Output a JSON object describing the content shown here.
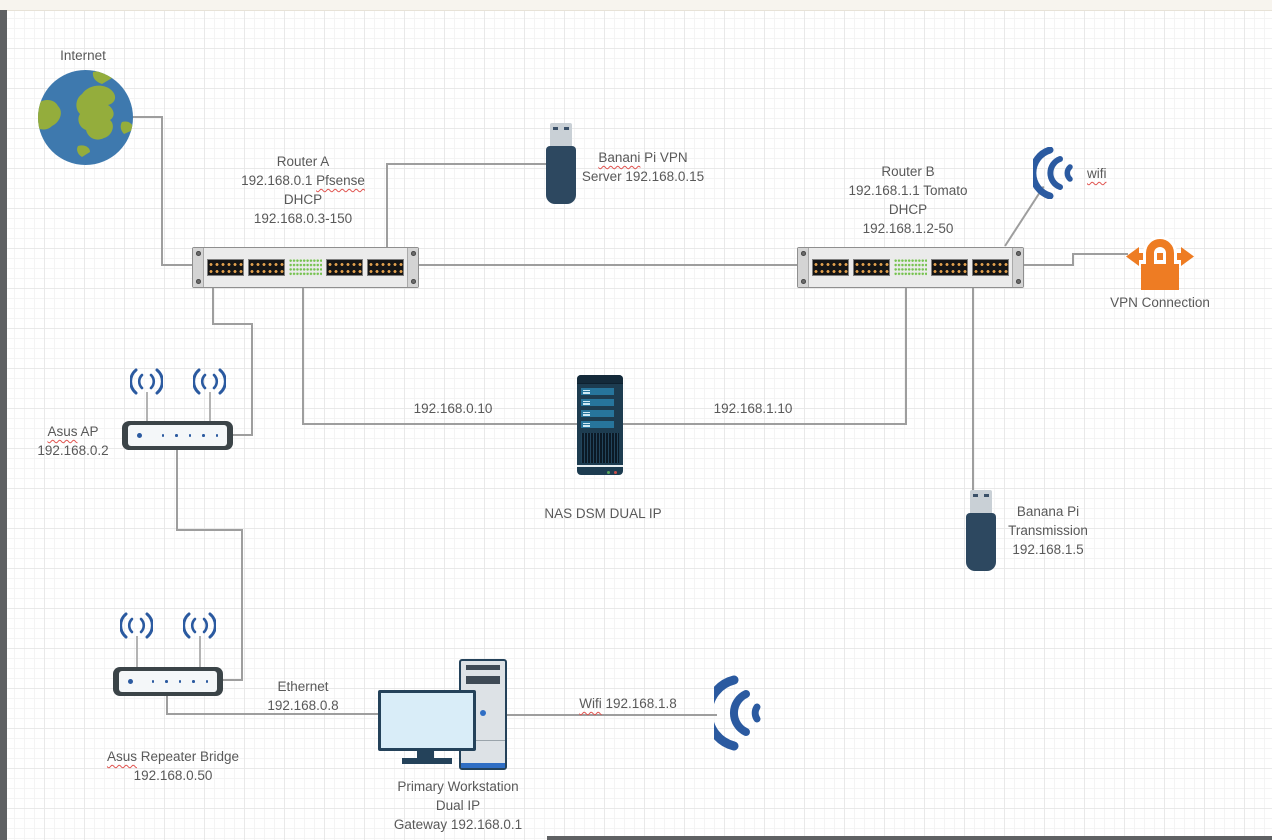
{
  "diagram_title": "Home network diagram (draw.io style canvas)",
  "colors": {
    "icon_blue": "#2b5aa0",
    "lock_orange": "#ee7c23",
    "globe_ocean": "#3e79ae",
    "globe_land": "#94ad3c",
    "connector_gray": "#9e9e9e",
    "led_green": "#76c24f",
    "port_pin_orange": "#e2a14e",
    "device_navy": "#2d4860",
    "text_gray": "#595959",
    "spellcheck_red": "#e0524e",
    "topbar_cream": "#f7f4ee",
    "scrollbar_gray": "#5f6163"
  },
  "nodes": {
    "internet": {
      "lines": [
        [
          {
            "t": "Internet"
          }
        ]
      ]
    },
    "router_a": {
      "lines": [
        [
          {
            "t": "Router A"
          }
        ],
        [
          {
            "t": "192.168.0.1 "
          },
          {
            "t": "Pfsense",
            "sq": true
          }
        ],
        [
          {
            "t": "DHCP"
          }
        ],
        [
          {
            "t": "192.168.0.3-150"
          }
        ]
      ]
    },
    "banani_pi_vpn": {
      "lines": [
        [
          {
            "t": "Banani",
            "sq": true
          },
          {
            "t": " Pi VPN"
          }
        ],
        [
          {
            "t": "Server 192.168.0.15"
          }
        ]
      ]
    },
    "router_b": {
      "lines": [
        [
          {
            "t": "Router B"
          }
        ],
        [
          {
            "t": "192.168.1.1 Tomato"
          }
        ],
        [
          {
            "t": "DHCP"
          }
        ],
        [
          {
            "t": "192.168.1.2-50"
          }
        ]
      ]
    },
    "wifi_top": {
      "lines": [
        [
          {
            "t": "wifi",
            "sq": true
          }
        ]
      ]
    },
    "vpn_connection": {
      "lines": [
        [
          {
            "t": "VPN Connection"
          }
        ]
      ]
    },
    "asus_ap": {
      "lines": [
        [
          {
            "t": "Asus",
            "sq": true
          },
          {
            "t": " AP"
          }
        ],
        [
          {
            "t": "192.168.0.2"
          }
        ]
      ]
    },
    "nas": {
      "lines": [
        [
          {
            "t": "NAS DSM DUAL IP"
          }
        ]
      ]
    },
    "banana_pi_transmission": {
      "lines": [
        [
          {
            "t": "Banana Pi"
          }
        ],
        [
          {
            "t": "Transmission"
          }
        ],
        [
          {
            "t": "192.168.1.5"
          }
        ]
      ]
    },
    "asus_repeater_bridge": {
      "lines": [
        [
          {
            "t": "Asus",
            "sq": true
          },
          {
            "t": " Repeater Bridge"
          }
        ],
        [
          {
            "t": "192.168.0.50"
          }
        ]
      ]
    },
    "workstation": {
      "lines": [
        [
          {
            "t": "Primary Workstation"
          }
        ],
        [
          {
            "t": "Dual IP"
          }
        ],
        [
          {
            "t": "Gateway 192.168.0.1"
          }
        ]
      ]
    }
  },
  "edge_labels": {
    "lan_a_nas": {
      "lines": [
        [
          {
            "t": "192.168.0.10"
          }
        ]
      ]
    },
    "lan_b_nas": {
      "lines": [
        [
          {
            "t": "192.168.1.10"
          }
        ]
      ]
    },
    "ethernet": {
      "lines": [
        [
          {
            "t": "Ethernet"
          }
        ],
        [
          {
            "t": "192.168.0.8"
          }
        ]
      ]
    },
    "wifi_link": {
      "lines": [
        [
          {
            "t": "Wifi",
            "sq": true
          },
          {
            "t": " 192.168.1.8"
          }
        ]
      ]
    }
  },
  "icons": [
    "globe-icon",
    "rack-switch-icon",
    "usb-stick-icon",
    "wifi-signal-icon",
    "vpn-lock-arrows-icon",
    "wireless-router-icon",
    "antenna-wifi-icon",
    "nas-tower-icon",
    "desktop-computer-icon"
  ]
}
